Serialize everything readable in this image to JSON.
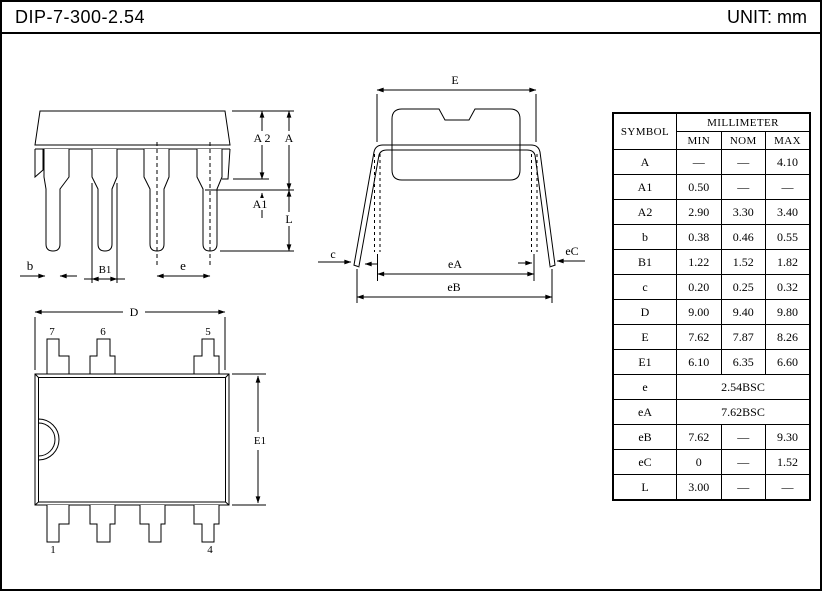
{
  "header": {
    "title": "DIP-7-300-2.54",
    "unit": "UNIT: mm"
  },
  "front_view": {
    "labels": {
      "A2": "A 2",
      "A": "A",
      "A1": "A1",
      "L": "L",
      "b": "b",
      "B1": "B1",
      "e": "e"
    }
  },
  "side_view": {
    "labels": {
      "E": "E",
      "c": "c",
      "eC": "eC",
      "eA": "eA",
      "eB": "eB"
    }
  },
  "top_view": {
    "labels": {
      "D": "D",
      "E1": "E1",
      "pin7": "7",
      "pin6": "6",
      "pin5": "5",
      "pin1": "1",
      "pin4": "4"
    }
  },
  "table": {
    "symbol_header": "SYMBOL",
    "unit_header": "MILLIMETER",
    "col_headers": [
      "MIN",
      "NOM",
      "MAX"
    ],
    "rows": [
      {
        "symbol": "A",
        "min": "—",
        "nom": "—",
        "max": "4.10"
      },
      {
        "symbol": "A1",
        "min": "0.50",
        "nom": "—",
        "max": "—"
      },
      {
        "symbol": "A2",
        "min": "2.90",
        "nom": "3.30",
        "max": "3.40"
      },
      {
        "symbol": "b",
        "min": "0.38",
        "nom": "0.46",
        "max": "0.55"
      },
      {
        "symbol": "B1",
        "min": "1.22",
        "nom": "1.52",
        "max": "1.82"
      },
      {
        "symbol": "c",
        "min": "0.20",
        "nom": "0.25",
        "max": "0.32"
      },
      {
        "symbol": "D",
        "min": "9.00",
        "nom": "9.40",
        "max": "9.80"
      },
      {
        "symbol": "E",
        "min": "7.62",
        "nom": "7.87",
        "max": "8.26"
      },
      {
        "symbol": "E1",
        "min": "6.10",
        "nom": "6.35",
        "max": "6.60"
      },
      {
        "symbol": "e",
        "span": "2.54BSC"
      },
      {
        "symbol": "eA",
        "span": "7.62BSC"
      },
      {
        "symbol": "eB",
        "min": "7.62",
        "nom": "—",
        "max": "9.30"
      },
      {
        "symbol": "eC",
        "min": "0",
        "nom": "—",
        "max": "1.52"
      },
      {
        "symbol": "L",
        "min": "3.00",
        "nom": "—",
        "max": "—"
      }
    ]
  },
  "colors": {
    "ink": "#000000",
    "paper": "#ffffff"
  }
}
